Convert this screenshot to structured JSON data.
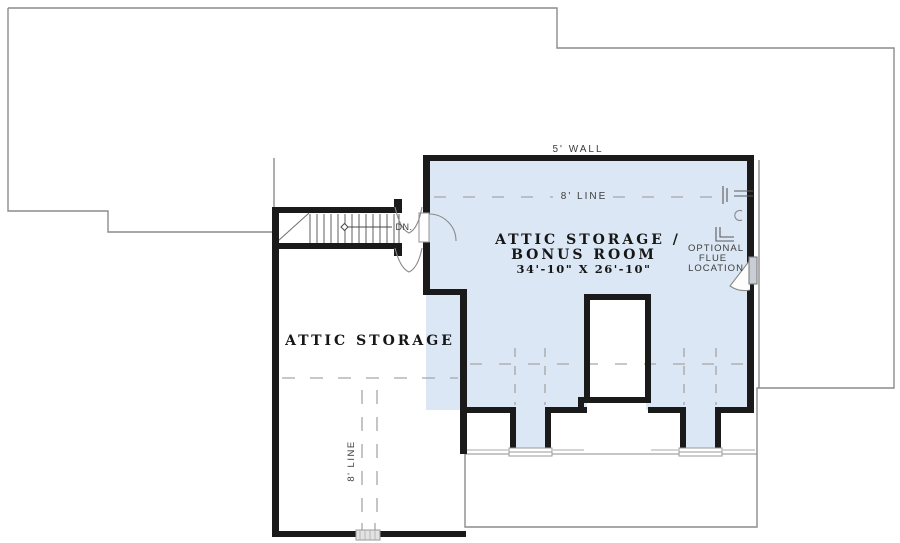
{
  "plan": {
    "labels": {
      "wall_height": "5' WALL",
      "ceiling_line_room": "8' LINE",
      "ceiling_line_left": "8' LINE",
      "stair_direction": "DN.",
      "bonus_room_name_line1": "ATTIC STORAGE /",
      "bonus_room_name_line2": "BONUS ROOM",
      "bonus_room_dimensions": "34'-10\" X 26'-10\"",
      "attic_storage_name": "ATTIC STORAGE",
      "flue_note_line1": "OPTIONAL",
      "flue_note_line2": "FLUE",
      "flue_note_line3": "LOCATION"
    },
    "colors": {
      "room_fill": "#dbe7f4",
      "wall": "#1a1a1a",
      "roof_outline": "#8c8c8c",
      "dashed_line": "#a6a6a6"
    }
  }
}
